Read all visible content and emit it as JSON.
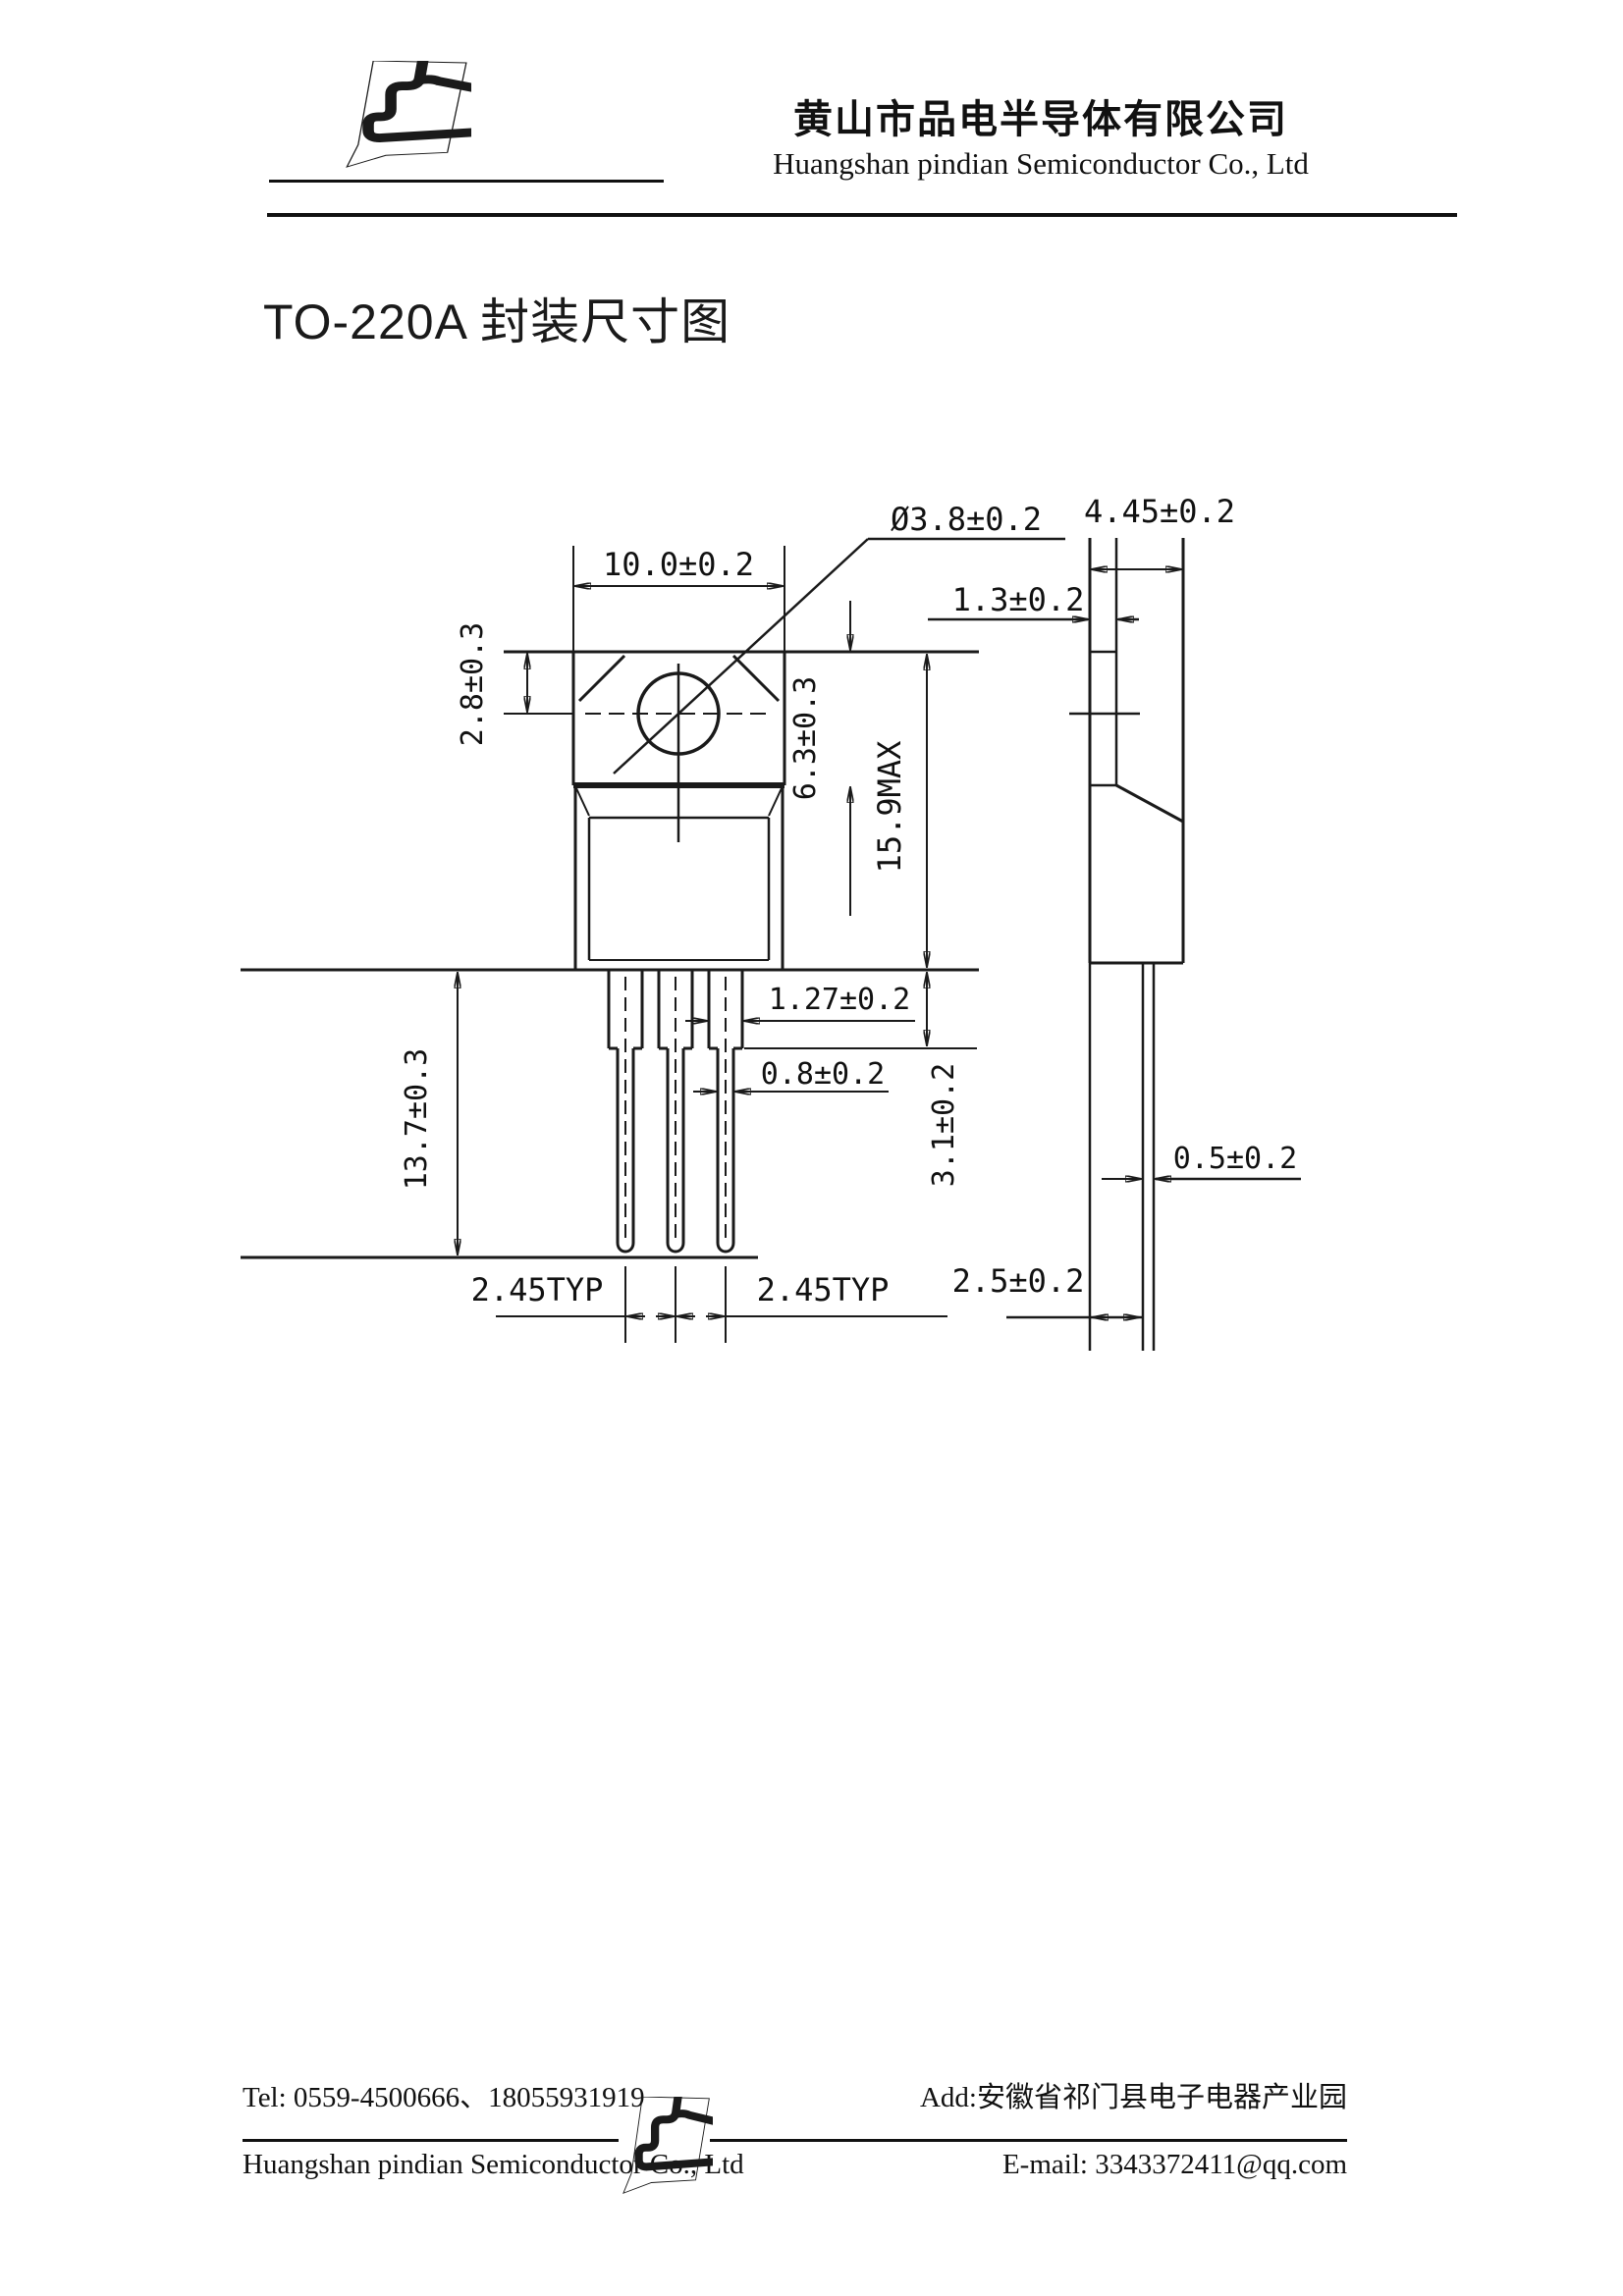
{
  "header": {
    "company_cn": "黄山市品电半导体有限公司",
    "company_en": "Huangshan  pindian Semiconductor Co., Ltd"
  },
  "title": "TO-220A 封装尺寸图",
  "drawing": {
    "dims": {
      "tab_width": "10.0±0.2",
      "hole_diameter": "Ø3.8±0.2",
      "body_width_side": "4.45±0.2",
      "tab_thickness": "1.3±0.2",
      "hole_center_offset": "2.8±0.3",
      "tab_height": "6.3±0.3",
      "overall_height": "15.9MAX",
      "lead_shoulder_width": "1.27±0.2",
      "lead_width": "0.8±0.2",
      "shoulder_height": "3.1±0.2",
      "lead_length": "13.7±0.3",
      "lead_pitch_1": "2.45TYP",
      "lead_pitch_2": "2.45TYP",
      "lead_center_offset": "2.5±0.2",
      "lead_thickness": "0.5±0.2"
    }
  },
  "footer": {
    "tel": "Tel: 0559-4500666、18055931919",
    "address": "Add:安徽省祁门县电子电器产业园",
    "company_en": "Huangshan  pindian Semiconductor Co., Ltd",
    "email": "E-mail: 3343372411@qq.com"
  },
  "colors": {
    "logo_blue": "#1766b0",
    "line": "#1a1a1a"
  }
}
